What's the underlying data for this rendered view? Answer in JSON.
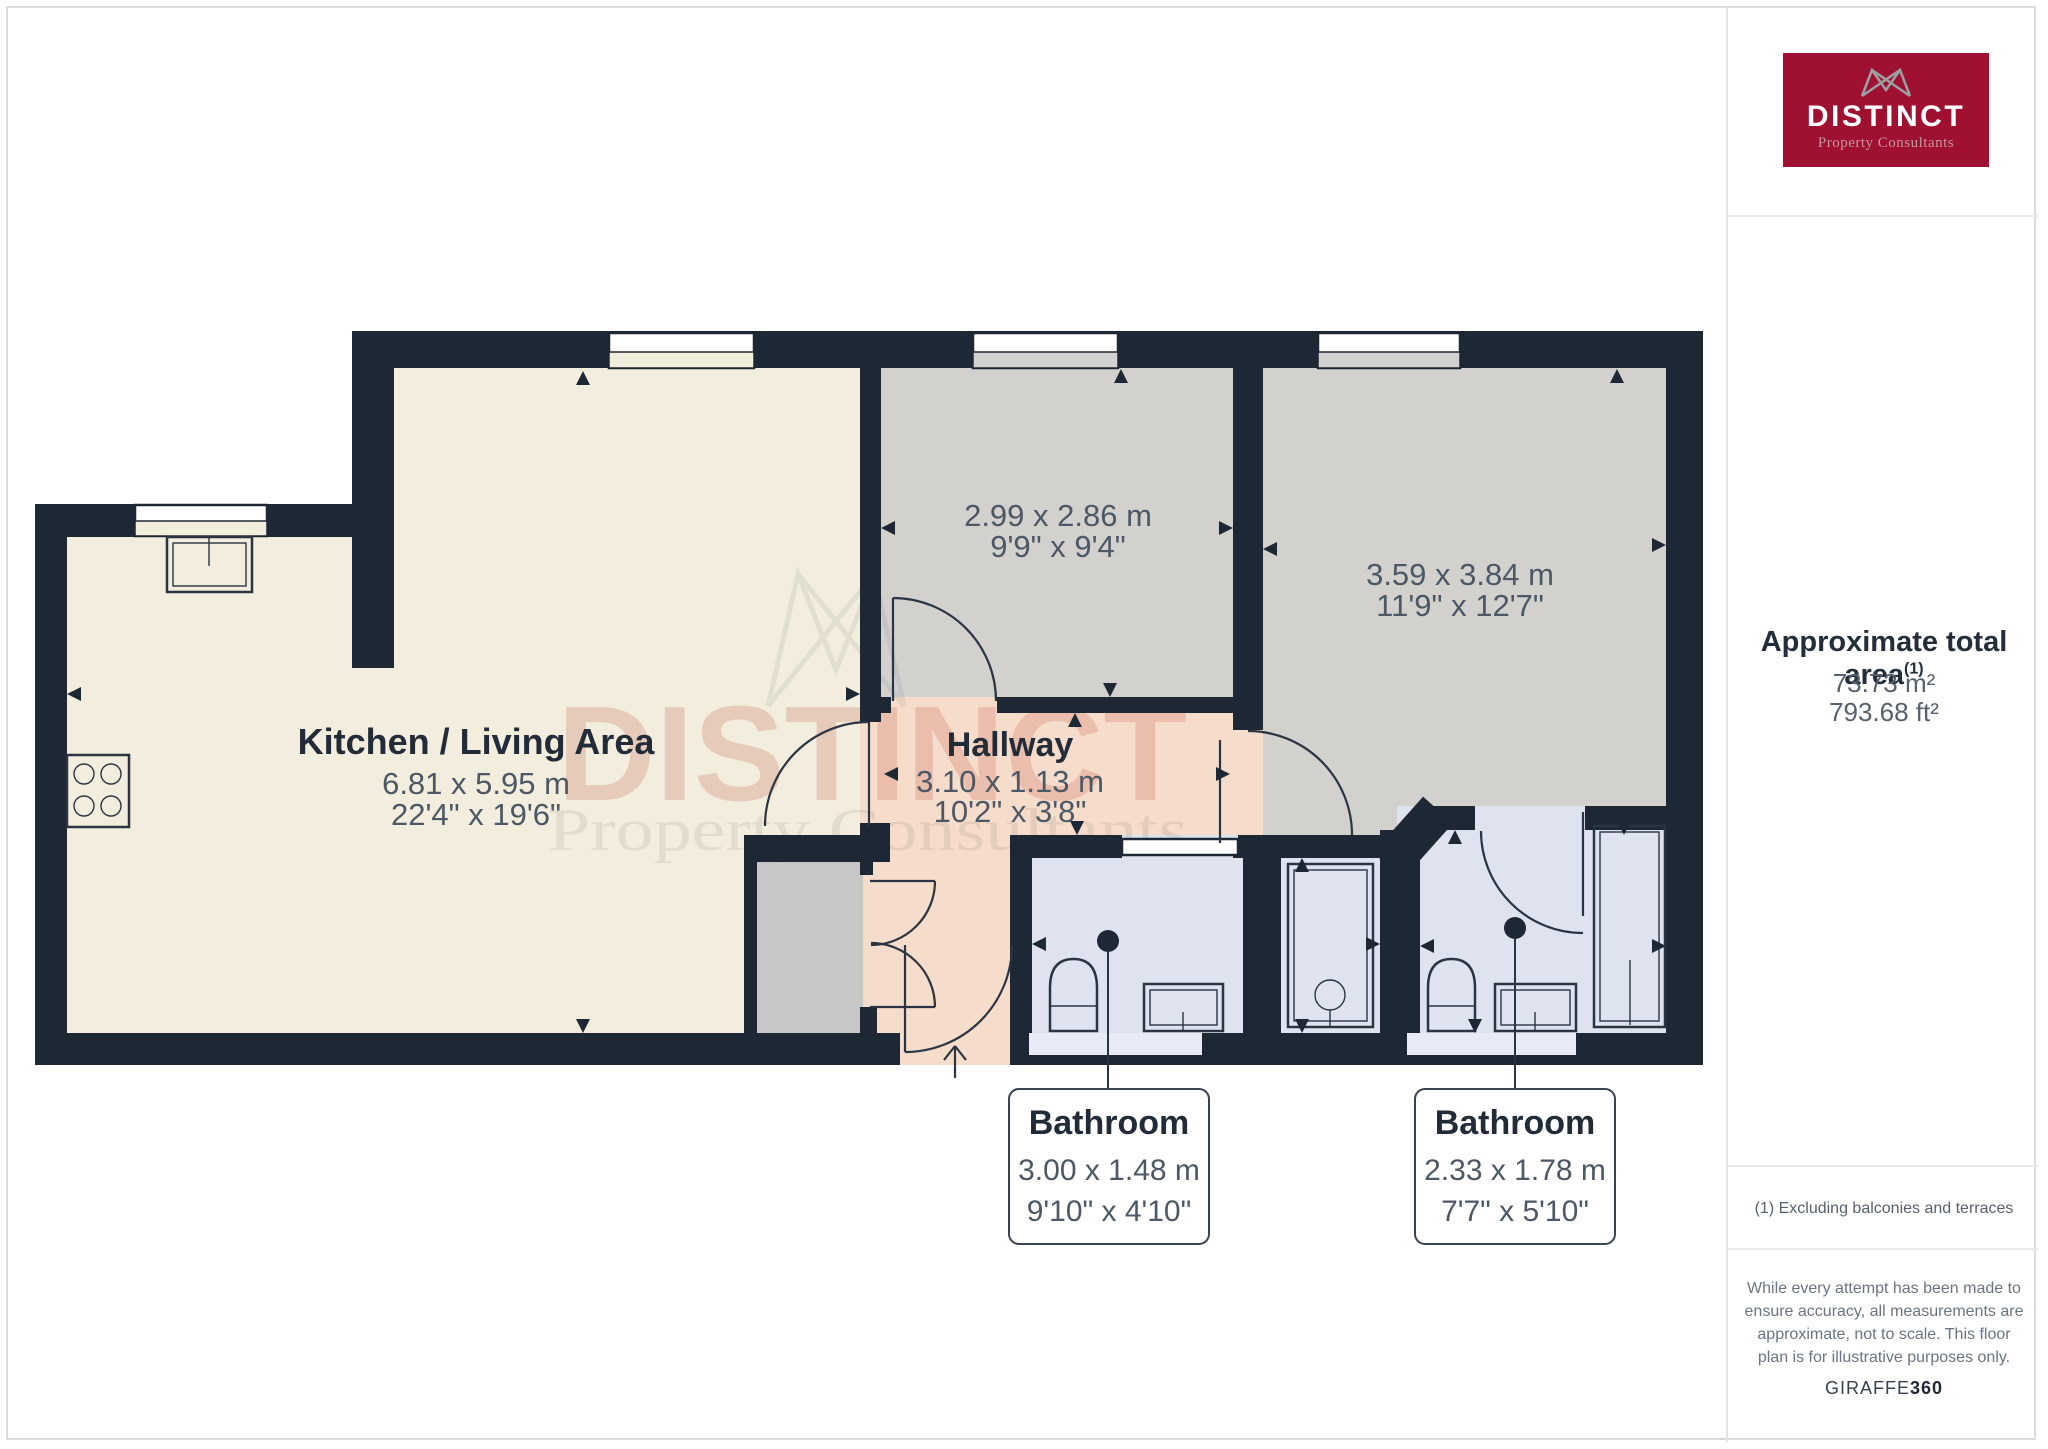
{
  "logo": {
    "name": "DISTINCT",
    "tagline": "Property Consultants"
  },
  "sidebar": {
    "area_title": "Approximate total area",
    "area_superscript": "(1)",
    "area_m2": "73.73 m²",
    "area_ft2": "793.68 ft²",
    "footnote": "(1) Excluding balconies and terraces",
    "disclaimer_lines": [
      "While every attempt has been made to",
      "ensure accuracy, all measurements are",
      "approximate, not to scale. This floor",
      "plan is for illustrative purposes only."
    ],
    "brand_regular": "GIRAFFE",
    "brand_bold": "360"
  },
  "rooms": {
    "kitchen": {
      "name": "Kitchen / Living Area",
      "metric": "6.81 x 5.95 m",
      "imperial": "22'4\" x 19'6\""
    },
    "bedroom1": {
      "metric": "2.99 x 2.86 m",
      "imperial": "9'9\" x 9'4\""
    },
    "bedroom2": {
      "metric": "3.59 x 3.84 m",
      "imperial": "11'9\" x 12'7\""
    },
    "hallway": {
      "name": "Hallway",
      "metric": "3.10 x 1.13 m",
      "imperial": "10'2\" x 3'8\""
    },
    "bathroom1": {
      "name": "Bathroom",
      "metric": "3.00 x 1.48 m",
      "imperial": "9'10\" x 4'10\""
    },
    "bathroom2": {
      "name": "Bathroom",
      "metric": "2.33 x 1.78 m",
      "imperial": "7'7\" x 5'10\""
    }
  },
  "watermark": {
    "line1": "DISTINCT",
    "line2": "Property Consultants"
  },
  "colors": {
    "wall": "#1E2734",
    "kitchen_floor": "#F2EDDC",
    "bedroom_floor": "#D2D1CE",
    "hallway_floor": "#F6DCCB",
    "bathroom_floor": "#DFE3F0",
    "threshold": "#E8EBF5",
    "closet_floor": "#C7C7C6",
    "brand_red": "#A01030",
    "divider": "#E4E4E4"
  }
}
